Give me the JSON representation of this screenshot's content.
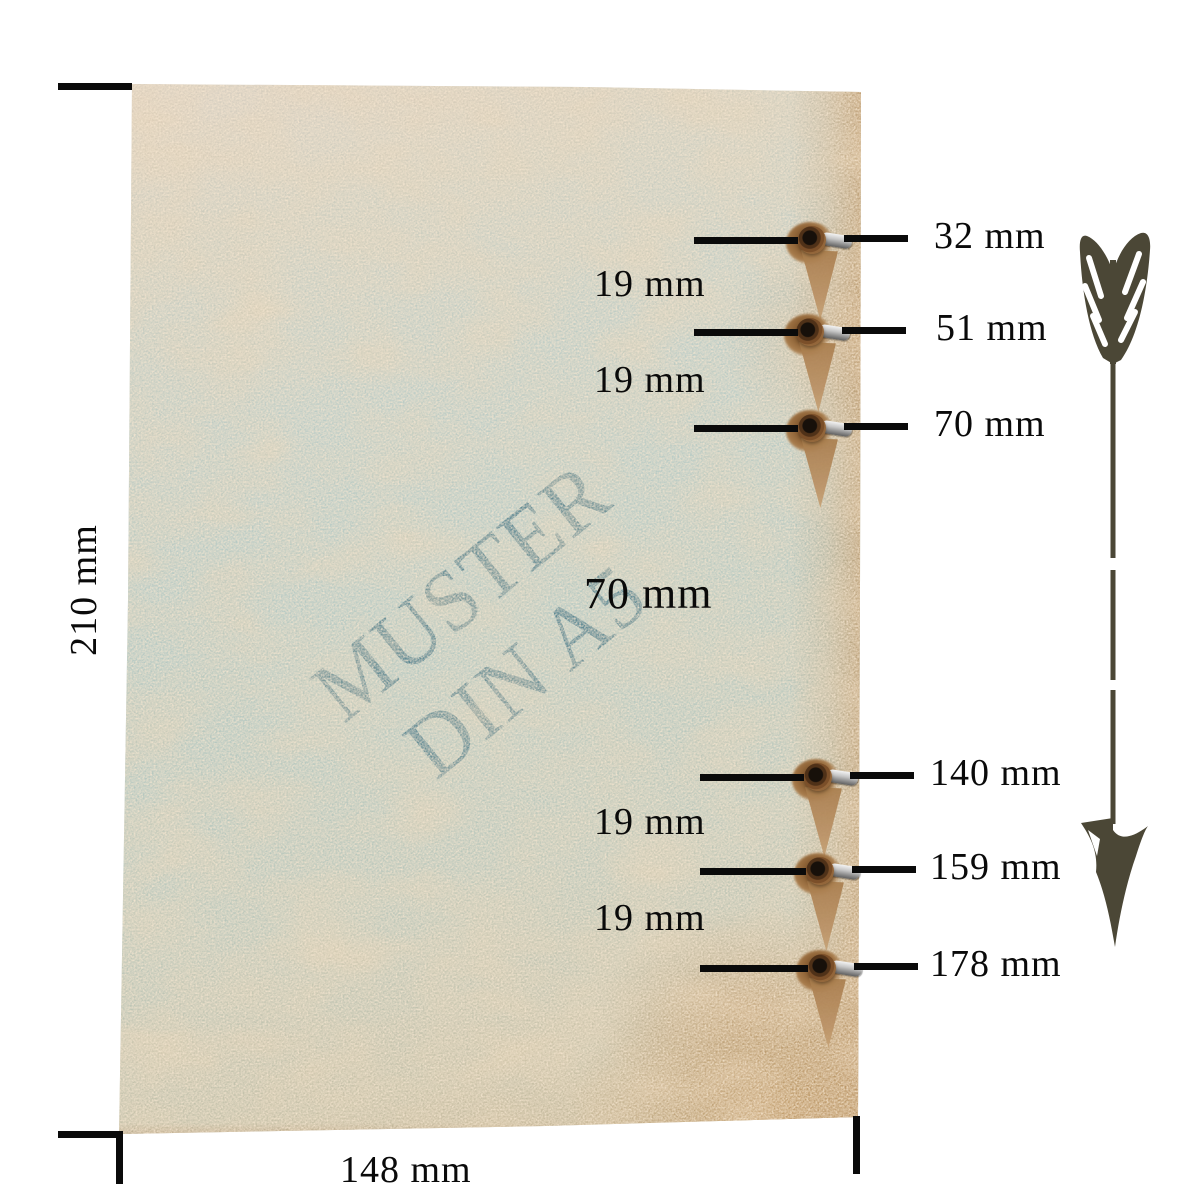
{
  "diagram": {
    "watermark": {
      "line1": "MUSTER",
      "line2": "DIN A5"
    },
    "sheet": {
      "height_label": "210 mm",
      "width_label": "148 mm"
    },
    "holes": [
      {
        "label": "32 mm"
      },
      {
        "label": "51 mm"
      },
      {
        "label": "70 mm"
      },
      {
        "label": "140 mm"
      },
      {
        "label": "159 mm"
      },
      {
        "label": "178 mm"
      }
    ],
    "spacings": [
      {
        "label": "19 mm"
      },
      {
        "label": "19 mm"
      },
      {
        "label": "70 mm"
      },
      {
        "label": "19 mm"
      },
      {
        "label": "19 mm"
      }
    ],
    "colors": {
      "watermark_teal": "#4e7f8e",
      "arrow_olive": "#4b4736",
      "line_ink": "#0a0a0a",
      "stain_brown": "#a87c4c",
      "paper_teal": "#b3c8c2",
      "paper_beige": "#d8cec0"
    }
  }
}
